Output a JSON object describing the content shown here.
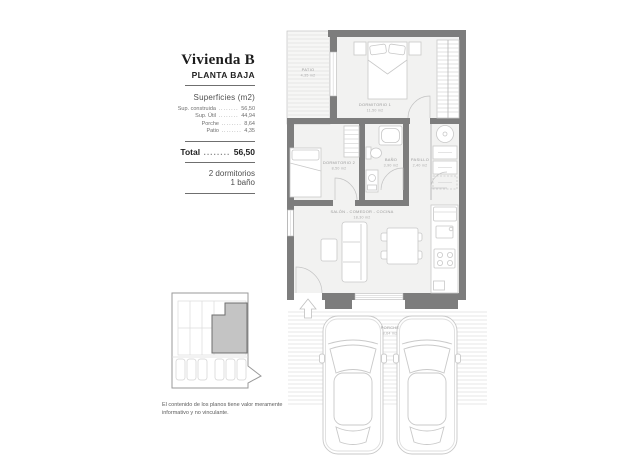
{
  "panel": {
    "title": "Vivienda B",
    "subtitle": "PLANTA BAJA",
    "surfaces_heading": "Superficies (m2)",
    "surfaces": [
      {
        "label": "Sup. construida",
        "value": "56,50"
      },
      {
        "label": "Sup. Útil",
        "value": "44,94"
      },
      {
        "label": "Porche",
        "value": "8,64"
      },
      {
        "label": "Patio",
        "value": "4,35"
      }
    ],
    "total": {
      "label": "Total",
      "value": "56,50"
    },
    "features": [
      "2 dormitorios",
      "1 baño"
    ],
    "disclaimer": "El contenido de los planos tiene valor meramente informativo y no vinculante."
  },
  "plan": {
    "rooms": {
      "dormitorio1": {
        "name": "DORMITORIO 1",
        "area": "11,50 m2"
      },
      "dormitorio2": {
        "name": "DORMITORIO 2",
        "area": "8,50 m2"
      },
      "bano": {
        "name": "BAÑO",
        "area": "3,90 m2"
      },
      "pasillo": {
        "name": "PASILLO",
        "area": "2,40 m2"
      },
      "salon": {
        "name": "SALÓN - COMEDOR - COCINA",
        "area": "18,30 m2"
      },
      "patio": {
        "name": "PATIO",
        "area": "4,35 m2"
      },
      "porche": {
        "name": "PORCHE",
        "area": "8,64 m2"
      }
    }
  },
  "colors": {
    "wall": "#7d7d7d",
    "room_fill": "#f2f2f1",
    "line": "#c8c8c8",
    "hatch": "#e0e0e0",
    "highlight": "#c4c4c4"
  }
}
